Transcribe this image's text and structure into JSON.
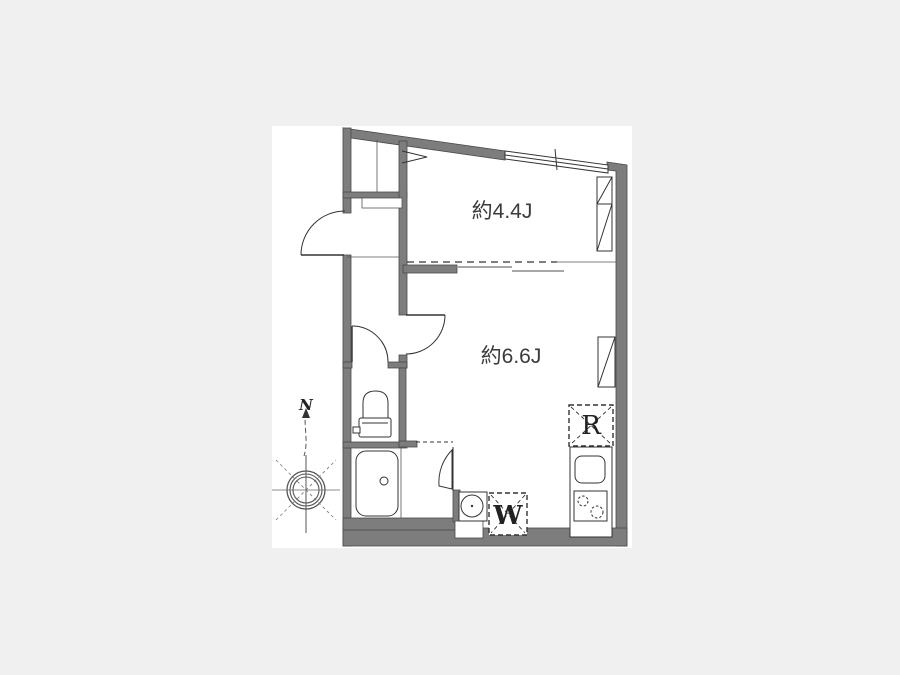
{
  "floorplan": {
    "rooms": {
      "room1_label": "約4.4J",
      "room2_label": "約6.6J"
    },
    "appliances": {
      "refrigerator_label": "R",
      "washer_label": "W"
    },
    "compass": {
      "north_label": "N"
    },
    "colors": {
      "background": "#f0f0f0",
      "panel": "#ffffff",
      "wall": "#7d7d7d",
      "line": "#333333",
      "text": "#3b3b3b"
    }
  }
}
